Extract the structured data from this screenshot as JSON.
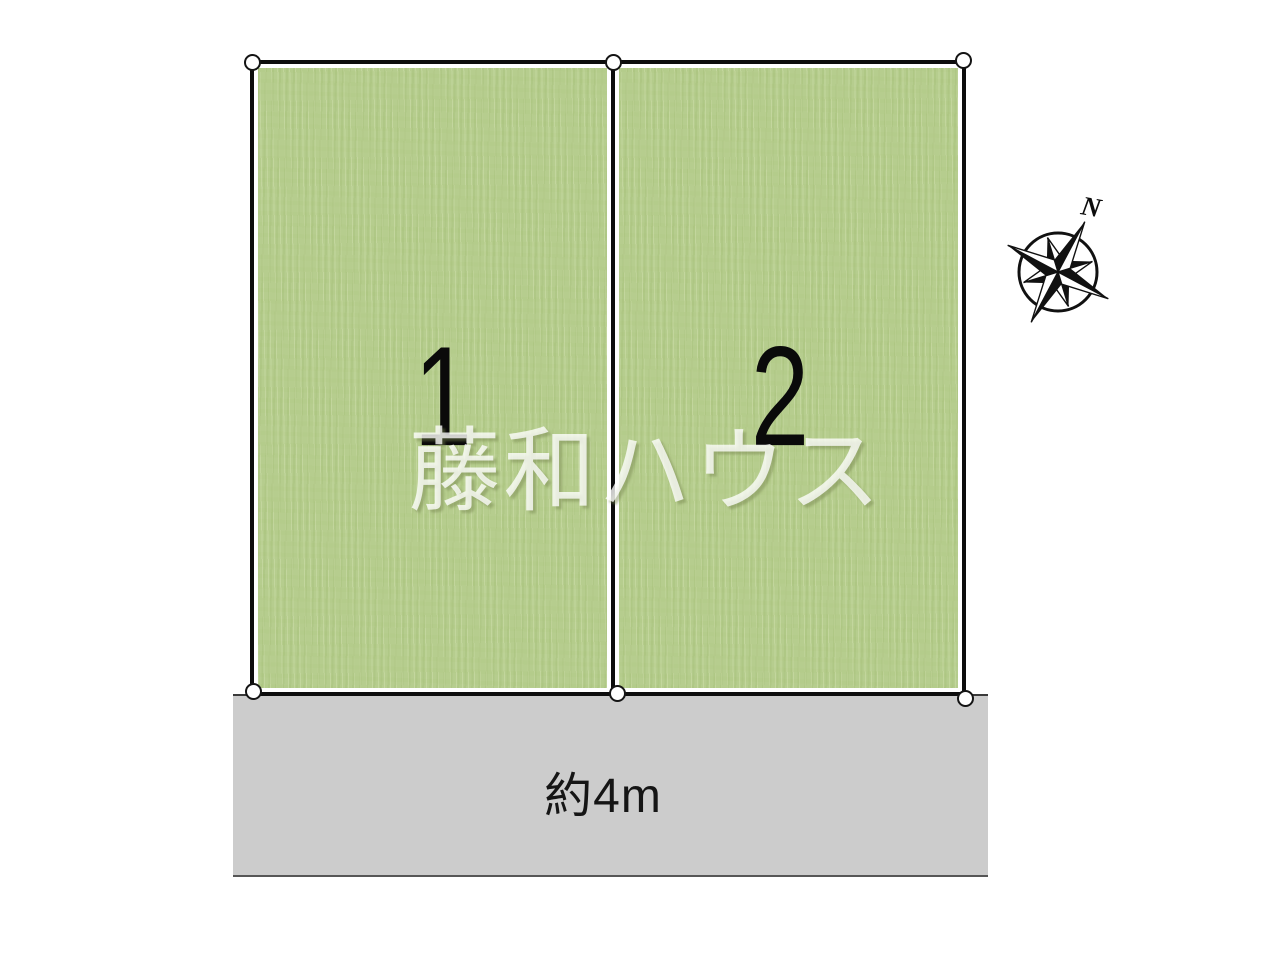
{
  "lots": [
    {
      "number": "1"
    },
    {
      "number": "2"
    }
  ],
  "road": {
    "width_label": "約4m"
  },
  "compass": {
    "north_label": "N"
  },
  "watermark": {
    "text": "藤和ハウス"
  },
  "colors": {
    "lot_fill": "#b6cd8e",
    "lot_border": "#0d0d0d",
    "road_fill": "#cccccc",
    "road_label_text": "#151515",
    "lot_number_text": "#0a0a0a",
    "marker_fill": "#ffffff",
    "marker_stroke": "#141414",
    "compass_ink": "#111111",
    "watermark_tint": "#ffffff",
    "page_background": "#ffffff"
  }
}
